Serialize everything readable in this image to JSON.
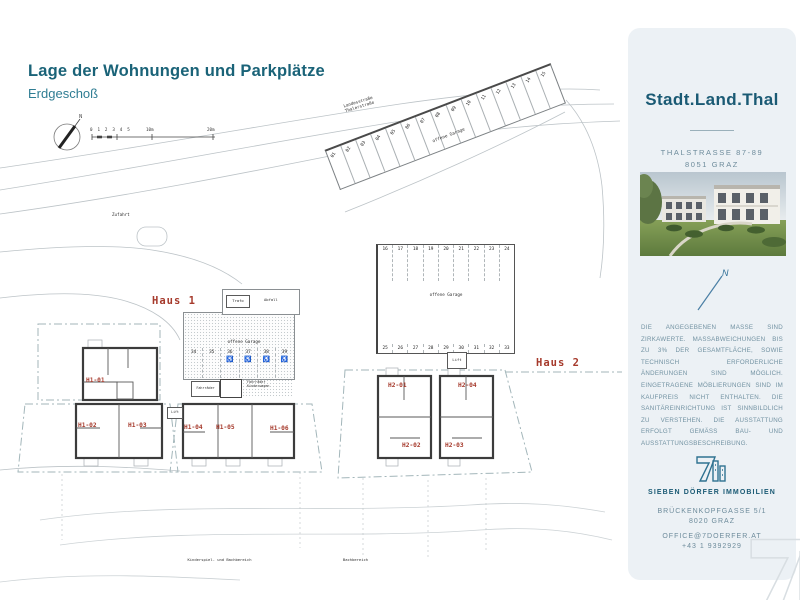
{
  "page": {
    "title": "Lage der Wohnungen und Parkplätze",
    "subtitle": "Erdgeschoß"
  },
  "plan": {
    "scale": {
      "ticks": "0 1 2 3 4 5",
      "m10": "10m",
      "m20": "20m"
    },
    "streets": {
      "line1": "Landesstraße",
      "line2": "Thalerstraße",
      "gehweg": "Gehweg",
      "zufahrt": "Zufahrt"
    },
    "labels": {
      "open_garage": "offene Garage",
      "trafo": "Trafo",
      "abfall": "Abfall",
      "lift": "Lift",
      "bikes": "Fahrräder",
      "prams": "Kinderwagen",
      "haus1": "Haus 1",
      "haus2": "Haus 2",
      "area_left": "Kinderspiel- und Bachbereich",
      "area_right": "Bachbereich"
    },
    "stalls": {
      "diagonal": [
        "01",
        "02",
        "03",
        "04",
        "05",
        "06",
        "07",
        "08",
        "09",
        "10",
        "11",
        "12",
        "13",
        "14",
        "15"
      ],
      "top": [
        "16",
        "17",
        "18",
        "19",
        "20",
        "21",
        "22",
        "23",
        "24"
      ],
      "bottom": [
        "25",
        "26",
        "27",
        "28",
        "29",
        "30",
        "31",
        "32",
        "33"
      ],
      "haus1": [
        {
          "n": "34",
          "icon": ""
        },
        {
          "n": "35",
          "icon": ""
        },
        {
          "n": "36",
          "icon": "♿"
        },
        {
          "n": "37",
          "icon": "♿"
        },
        {
          "n": "38",
          "icon": "♿"
        },
        {
          "n": "39",
          "icon": "♿"
        }
      ]
    },
    "units": {
      "h1_01": "H1-01",
      "h1_02": "H1-02",
      "h1_03": "H1-03",
      "h1_04": "H1-04",
      "h1_05": "H1-05",
      "h1_06": "H1-06",
      "h2_01": "H2-01",
      "h2_02": "H2-02",
      "h2_03": "H2-03",
      "h2_04": "H2-04"
    }
  },
  "sidebar": {
    "brand": "Stadt.Land.Thal",
    "address1": "THALSTRASSE 87-89",
    "address2": "8051 GRAZ",
    "disclaimer": "DIE ANGEGEBENEN MASSE SIND ZIRKAWERTE. MASSABWEICHUNGEN BIS ZU 3% DER GESAMTFLÄCHE, SOWIE TECHNISCH ERFORDERLICHE ÄNDERUNGEN SIND MÖGLICH. EINGETRAGENE MÖBLIERUNGEN SIND IM KAUFPREIS NICHT ENTHALTEN. DIE SANITÄREINRICHTUNG IST SINNBILDLICH ZU VERSTEHEN. DIE AUSSTATTUNG ERFOLGT GEMÄSS BAU- UND AUSSTATTUNGSBESCHREIBUNG.",
    "company": "SIEBEN DÖRFER IMMOBILIEN",
    "company_address1": "BRÜCKENKOPFGASSE 5/1",
    "company_address2": "8020 GRAZ",
    "email": "OFFICE@7DOERFER.AT",
    "phone": "+43 1 9392929"
  },
  "icons": {
    "north": "N",
    "wheelchair": "♿"
  },
  "colors": {
    "accent_teal": "#1a6378",
    "brand_teal": "#1a5a74",
    "unit_red": "#a63a2c",
    "sidebar_bg": "#ecf1f5",
    "muted_text": "#6d8b9b"
  }
}
